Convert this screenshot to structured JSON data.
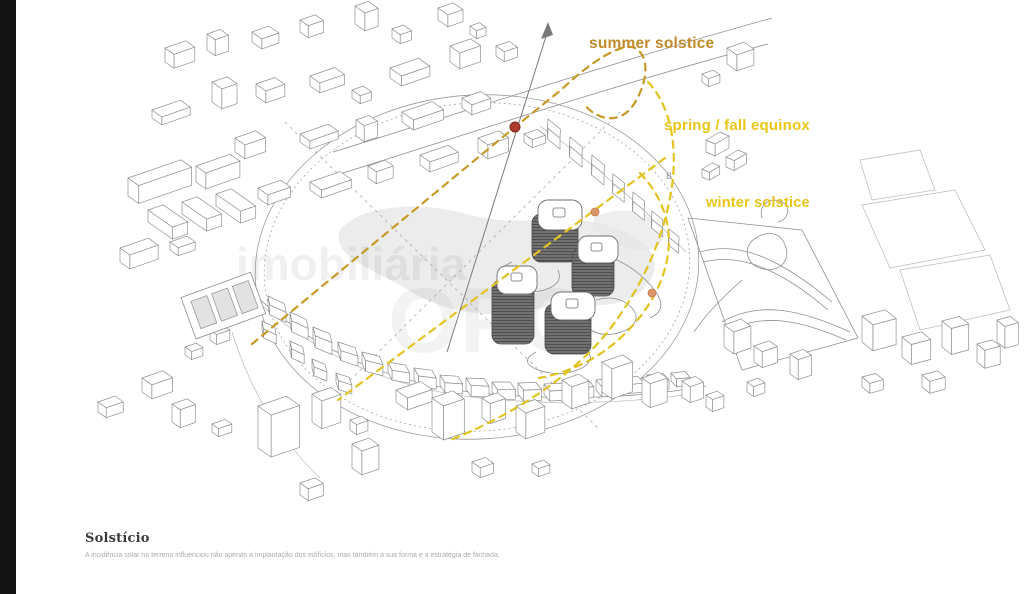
{
  "watermark": {
    "brand_small": "imobiliária",
    "brand_large_fragment": "OPC"
  },
  "diagram": {
    "labels": {
      "summer": "summer solstice",
      "equinox": "spring / fall equinox",
      "winter": "winter solstice",
      "marker_b": "B"
    },
    "colors": {
      "summer_label": "#c08b28",
      "summer_path": "#c79a27",
      "equinox_label": "#e9c517",
      "equinox_path": "#e3c31f",
      "winter_label": "#e9c517",
      "winter_path": "#e3c31f",
      "sun_marker_red": "#b03a2e",
      "sun_marker_orange": "#dd9668",
      "linework": "#8f8f8f"
    },
    "buildings": [
      [
        165,
        62,
        22,
        11,
        14
      ],
      [
        207,
        50,
        14,
        10,
        16
      ],
      [
        252,
        42,
        18,
        12,
        10
      ],
      [
        300,
        32,
        16,
        10,
        12
      ],
      [
        355,
        24,
        14,
        12,
        18
      ],
      [
        392,
        38,
        12,
        10,
        9
      ],
      [
        438,
        20,
        16,
        12,
        12
      ],
      [
        470,
        34,
        10,
        8,
        8
      ],
      [
        152,
        118,
        30,
        12,
        8
      ],
      [
        212,
        102,
        16,
        12,
        20
      ],
      [
        256,
        96,
        20,
        12,
        12
      ],
      [
        310,
        86,
        26,
        12,
        10
      ],
      [
        352,
        98,
        12,
        10,
        8
      ],
      [
        390,
        78,
        30,
        14,
        10
      ],
      [
        450,
        62,
        22,
        12,
        16
      ],
      [
        496,
        56,
        14,
        10,
        10
      ],
      [
        235,
        152,
        22,
        12,
        14
      ],
      [
        300,
        142,
        30,
        12,
        8
      ],
      [
        356,
        136,
        14,
        10,
        16
      ],
      [
        402,
        122,
        32,
        14,
        10
      ],
      [
        462,
        108,
        20,
        12,
        10
      ],
      [
        128,
        196,
        56,
        13,
        18
      ],
      [
        196,
        182,
        36,
        12,
        16
      ],
      [
        148,
        222,
        16,
        30,
        12
      ],
      [
        182,
        214,
        16,
        30,
        12
      ],
      [
        216,
        206,
        16,
        30,
        12
      ],
      [
        258,
        198,
        24,
        12,
        10
      ],
      [
        310,
        190,
        32,
        14,
        8
      ],
      [
        368,
        178,
        18,
        10,
        12
      ],
      [
        420,
        165,
        30,
        12,
        10
      ],
      [
        478,
        152,
        22,
        12,
        14
      ],
      [
        524,
        142,
        14,
        10,
        8
      ],
      [
        120,
        262,
        30,
        12,
        14
      ],
      [
        170,
        250,
        18,
        10,
        8
      ],
      [
        548,
        130,
        16,
        9,
        11,
        39
      ],
      [
        570,
        148,
        16,
        9,
        11,
        39
      ],
      [
        592,
        166,
        16,
        9,
        11,
        39
      ],
      [
        613,
        184,
        15,
        9,
        10,
        39
      ],
      [
        633,
        202,
        15,
        9,
        10,
        39
      ],
      [
        652,
        220,
        14,
        8,
        9,
        39
      ],
      [
        669,
        237,
        13,
        8,
        8,
        39
      ],
      [
        268,
        306,
        18,
        9,
        10,
        25
      ],
      [
        290,
        323,
        18,
        9,
        11,
        25
      ],
      [
        313,
        339,
        18,
        9,
        12,
        22
      ],
      [
        338,
        352,
        18,
        9,
        10,
        18
      ],
      [
        362,
        363,
        18,
        9,
        11,
        14
      ],
      [
        388,
        372,
        18,
        9,
        10,
        10
      ],
      [
        414,
        379,
        18,
        9,
        11,
        7
      ],
      [
        440,
        385,
        18,
        9,
        10,
        4
      ],
      [
        466,
        389,
        18,
        9,
        11,
        2
      ],
      [
        492,
        392,
        18,
        9,
        10,
        0
      ],
      [
        518,
        394,
        18,
        9,
        11,
        -2
      ],
      [
        544,
        394,
        18,
        9,
        10,
        -3
      ],
      [
        570,
        392,
        18,
        9,
        11,
        -4
      ],
      [
        596,
        390,
        18,
        9,
        10,
        -5
      ],
      [
        622,
        387,
        16,
        9,
        9,
        -6
      ],
      [
        647,
        384,
        16,
        9,
        9,
        -6
      ],
      [
        671,
        381,
        14,
        8,
        8,
        -6
      ],
      [
        290,
        350,
        14,
        8,
        9,
        25
      ],
      [
        312,
        368,
        14,
        8,
        9,
        22
      ],
      [
        336,
        382,
        14,
        8,
        9,
        18
      ],
      [
        262,
        330,
        14,
        8,
        9,
        25
      ],
      [
        210,
        340,
        14,
        8,
        10
      ],
      [
        185,
        355,
        12,
        8,
        8
      ],
      [
        258,
        448,
        30,
        16,
        42
      ],
      [
        312,
        422,
        20,
        12,
        28
      ],
      [
        352,
        468,
        18,
        12,
        24
      ],
      [
        396,
        402,
        26,
        14,
        12
      ],
      [
        432,
        432,
        22,
        14,
        34
      ],
      [
        482,
        418,
        16,
        10,
        20
      ],
      [
        516,
        432,
        20,
        12,
        26
      ],
      [
        562,
        402,
        18,
        12,
        22
      ],
      [
        602,
        392,
        22,
        12,
        30
      ],
      [
        642,
        402,
        18,
        10,
        24
      ],
      [
        682,
        397,
        14,
        10,
        16
      ],
      [
        706,
        407,
        12,
        8,
        12
      ],
      [
        472,
        472,
        14,
        10,
        10
      ],
      [
        532,
        472,
        12,
        8,
        8
      ],
      [
        300,
        495,
        16,
        10,
        12
      ],
      [
        350,
        430,
        12,
        8,
        10
      ],
      [
        142,
        392,
        22,
        12,
        14
      ],
      [
        98,
        412,
        18,
        10,
        10
      ],
      [
        172,
        422,
        16,
        10,
        18
      ],
      [
        212,
        432,
        14,
        8,
        8
      ],
      [
        706,
        152,
        16,
        10,
        12,
        -30
      ],
      [
        726,
        167,
        14,
        9,
        10,
        -30
      ],
      [
        702,
        177,
        12,
        8,
        8,
        -30
      ],
      [
        727,
        64,
        18,
        12,
        16
      ],
      [
        702,
        82,
        12,
        8,
        8
      ],
      [
        724,
        347,
        18,
        12,
        22
      ],
      [
        754,
        362,
        16,
        10,
        16
      ],
      [
        790,
        374,
        14,
        10,
        20
      ],
      [
        747,
        392,
        12,
        8,
        10
      ],
      [
        862,
        342,
        24,
        14,
        26,
        -15
      ],
      [
        902,
        357,
        20,
        12,
        20,
        -15
      ],
      [
        942,
        347,
        18,
        12,
        26,
        -15
      ],
      [
        977,
        362,
        16,
        10,
        18,
        -15
      ],
      [
        922,
        387,
        16,
        10,
        12,
        -15
      ],
      [
        862,
        387,
        14,
        10,
        10,
        -15
      ],
      [
        997,
        342,
        14,
        10,
        22,
        -15
      ]
    ]
  },
  "caption": {
    "title": "Solstício",
    "body": "A incidência solar no terreno influenciou não apenas a implantação dos edifícios, mas também a sua forma e a estratégia de fachada."
  }
}
